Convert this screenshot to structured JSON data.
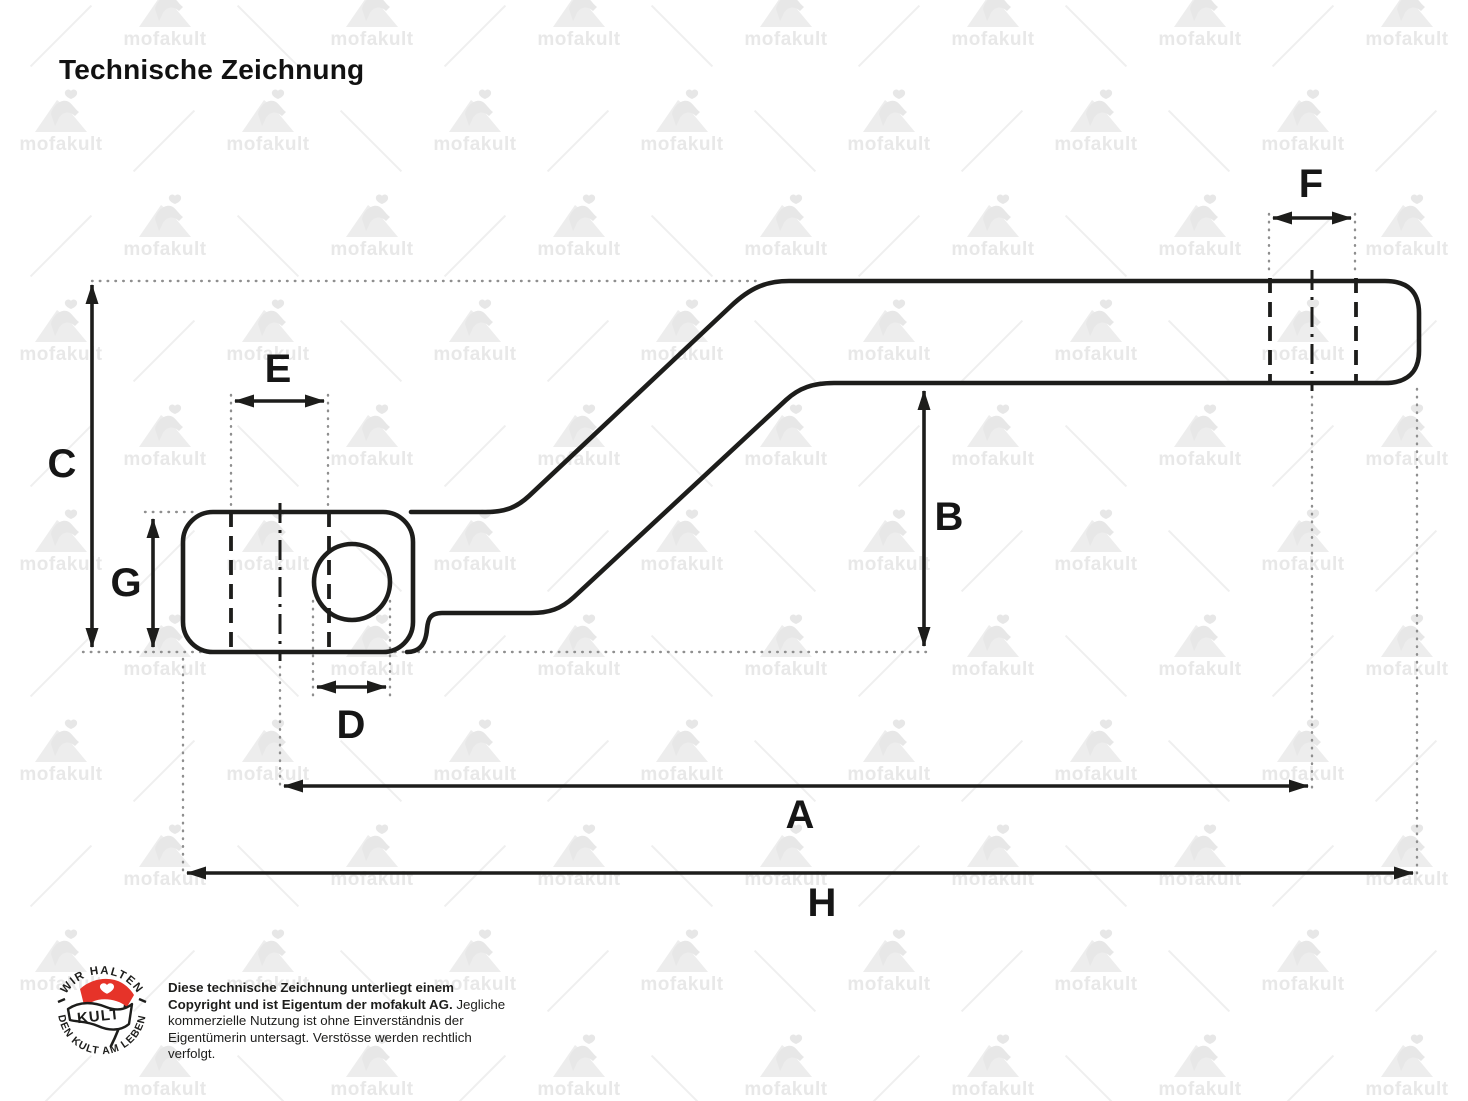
{
  "title": "Technische Zeichnung",
  "watermark": {
    "text": "mofakult"
  },
  "drawing": {
    "line_color": "#1d1d1b",
    "extension_color": "#8f8f8f",
    "dimensions": [
      {
        "label": "A"
      },
      {
        "label": "B"
      },
      {
        "label": "C"
      },
      {
        "label": "D"
      },
      {
        "label": "E"
      },
      {
        "label": "F"
      },
      {
        "label": "G"
      },
      {
        "label": "H"
      }
    ]
  },
  "footer": {
    "badge": {
      "top_text": "WIR HALTEN",
      "flag_text": "KULT",
      "bottom_text": "DEN KULT AM LEBEN",
      "flag_color": "#e63329"
    },
    "copyright_bold": "Diese technische Zeichnung unterliegt einem Copyright und ist Eigentum der mofakult AG.",
    "copyright_regular": " Jegliche kommerzielle Nutzung ist ohne Einverständnis der Eigentümerin untersagt. Verstösse werden rechtlich verfolgt."
  }
}
